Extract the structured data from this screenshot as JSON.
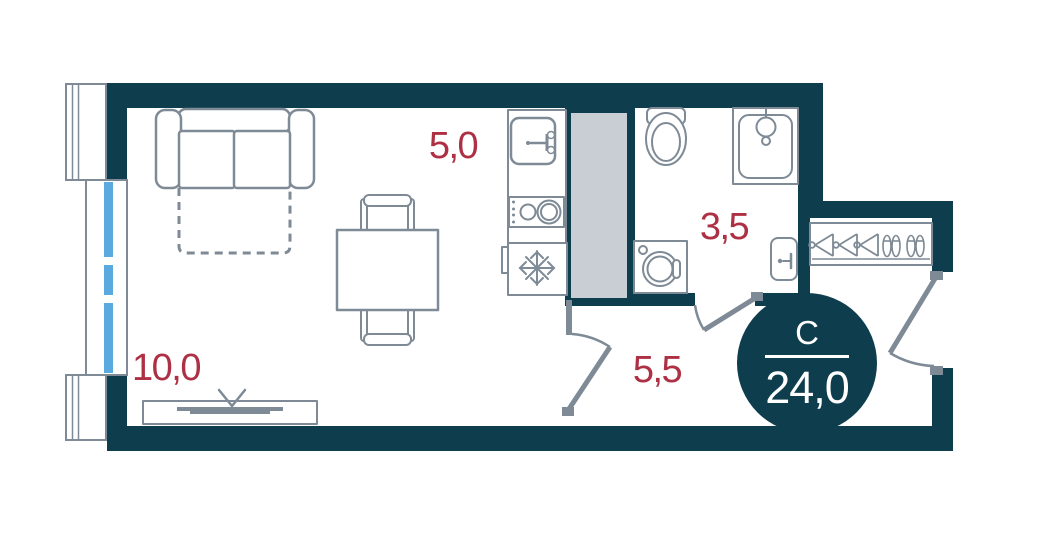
{
  "plan_title": "studio-apartment-floor-plan",
  "badge": {
    "type": "С",
    "area": "24,0"
  },
  "rooms": {
    "living": {
      "area": "10,0"
    },
    "kitchen": {
      "area": "5,0"
    },
    "bathroom": {
      "area": "3,5"
    },
    "hallway": {
      "area": "5,5"
    }
  },
  "colors": {
    "wall": "#0e3d4e",
    "line": "#7e8a96",
    "shaft": "#c8ced4",
    "glass": "#5aaadf",
    "area_label": "#ae3044"
  },
  "icons": [
    "sofa",
    "pull-out-bed-dashed",
    "dining-table",
    "chair",
    "tv-stand",
    "tv-antenna-icon",
    "kitchen-counter",
    "kitchen-sink-icon",
    "faucet-icon",
    "cooktop-burners-icon",
    "fridge-snowflake-icon",
    "ventilation-shaft",
    "toilet-icon",
    "shower-cabin-icon",
    "shower-head-icon",
    "washing-machine-icon",
    "bathroom-basin-icon",
    "wardrobe",
    "hanger-icon",
    "shoes-icon",
    "door-swing-arc",
    "window-glazing",
    "balcony-parapet"
  ]
}
